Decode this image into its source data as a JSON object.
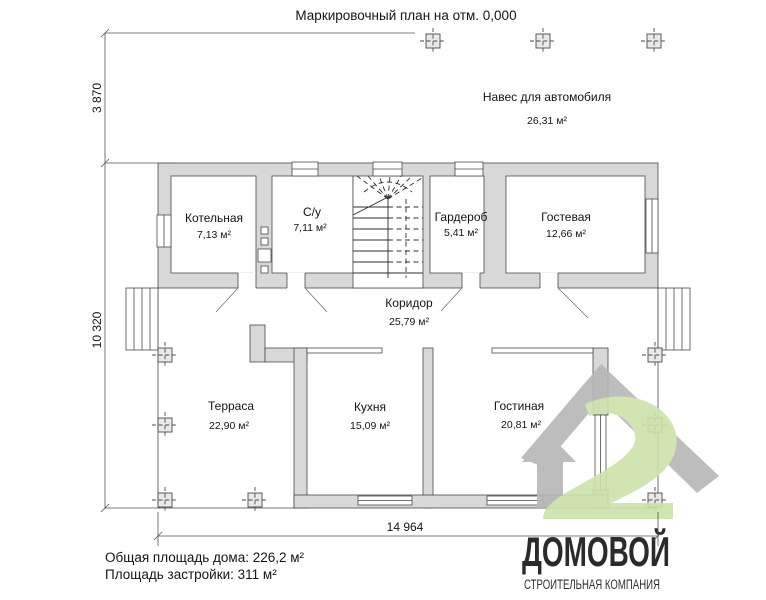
{
  "title": "Маркировочный план на отм. 0,000",
  "carport": {
    "label": "Навес для автомобиля",
    "area": "26,31 м²"
  },
  "rooms": [
    {
      "name": "Котельная",
      "area": "7,13 м²"
    },
    {
      "name": "С/у",
      "area": "7,11 м²"
    },
    {
      "name": "Гардероб",
      "area": "5,41 м²"
    },
    {
      "name": "Гостевая",
      "area": "12,66 м²"
    },
    {
      "name": "Коридор",
      "area": "25,79 м²"
    },
    {
      "name": "Терраса",
      "area": "22,90 м²"
    },
    {
      "name": "Кухня",
      "area": "15,09 м²"
    },
    {
      "name": "Гостиная",
      "area": "20,81 м²"
    }
  ],
  "dimensions": {
    "height_top": "3 870",
    "height_left": "10 320",
    "width_bottom": "14 964"
  },
  "summary": {
    "line1": "Общая площадь дома: 226,2 м²",
    "line2": "Площадь застройки: 311 м²"
  },
  "logo": {
    "name": "ДОМОВОЙ",
    "subtitle": "СТРОИТЕЛЬНАЯ КОМПАНИЯ"
  },
  "colors": {
    "wall_fill": "#d8d8d8",
    "line": "#4a4a4a",
    "logo_gray": "#b6b6b6",
    "logo_green": "#cde3ab",
    "logo_text_gray": "#bdbdbd",
    "logo_text_green": "#a6c478"
  }
}
